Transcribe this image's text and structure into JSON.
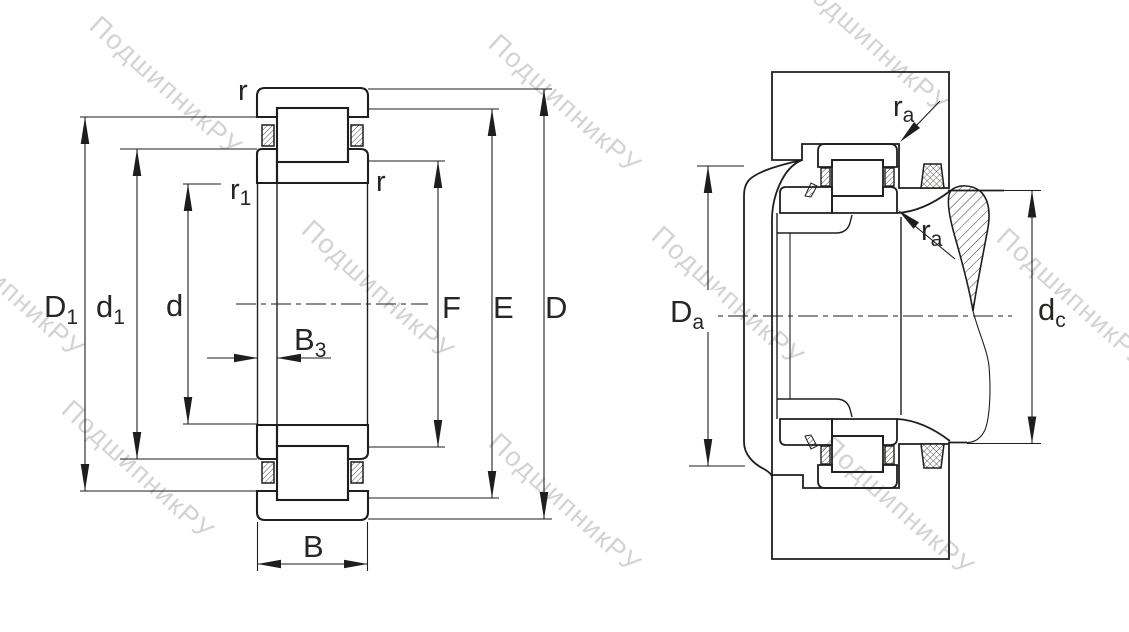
{
  "watermark": {
    "text": "ПодшипникРУ",
    "color": "#c3c3c3"
  },
  "drawing": {
    "background": "#ffffff",
    "line_color": "#1e1e1c",
    "label_color": "#262624"
  },
  "left_view": {
    "description": "bearing-cross-section",
    "labels": {
      "r_top": "r",
      "r1": {
        "base": "r",
        "sub": "1"
      },
      "r_right": "r",
      "D1": {
        "base": "D",
        "sub": "1"
      },
      "d1": {
        "base": "d",
        "sub": "1"
      },
      "d": "d",
      "B3": {
        "base": "B",
        "sub": "3"
      },
      "F": "F",
      "E": "E",
      "D": "D",
      "B": "B"
    }
  },
  "right_view": {
    "description": "mounted-bearing-section",
    "labels": {
      "Da": {
        "base": "D",
        "sub": "a"
      },
      "dc": {
        "base": "d",
        "sub": "c"
      },
      "ra_top": {
        "base": "r",
        "sub": "a"
      },
      "ra_bottom": {
        "base": "r",
        "sub": "a"
      }
    }
  }
}
